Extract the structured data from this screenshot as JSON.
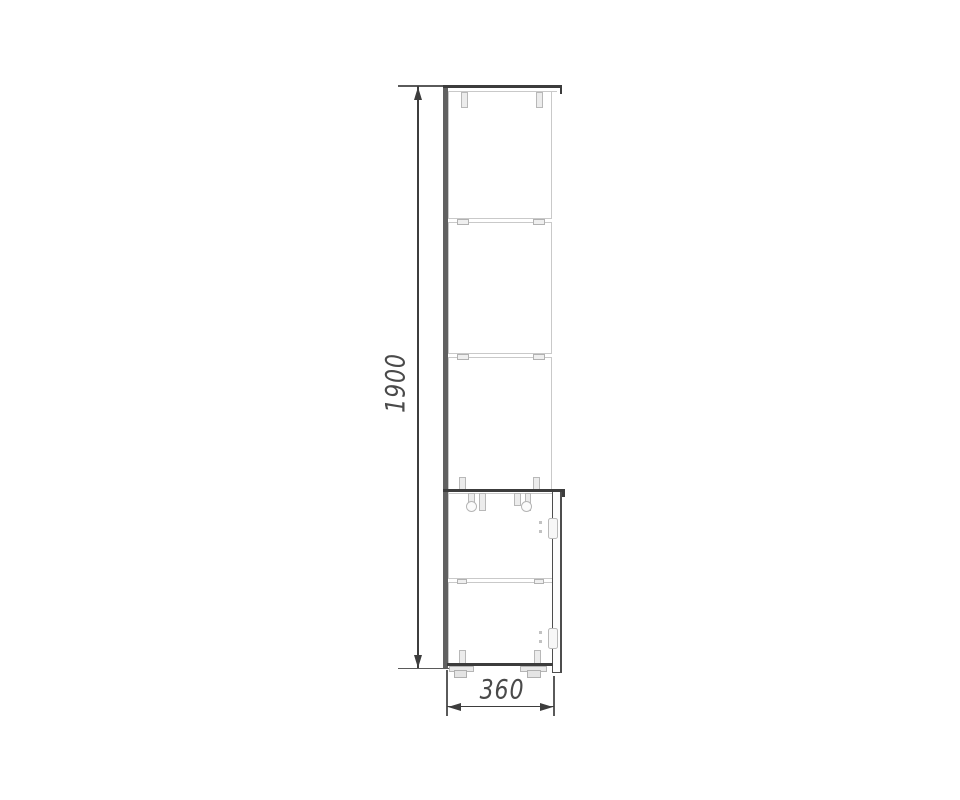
{
  "drawing": {
    "title": "tall-cabinet-side-view-technical-drawing",
    "dimensions": {
      "height_label": "1900",
      "width_label": "360"
    },
    "colors": {
      "background": "#ffffff",
      "dim_line": "#3d3d3d",
      "dim_text": "#4a4a4a",
      "panel_dark": "#616161",
      "panel_edge": "#3c3c3c",
      "part_light": "#c9c9c9"
    }
  }
}
